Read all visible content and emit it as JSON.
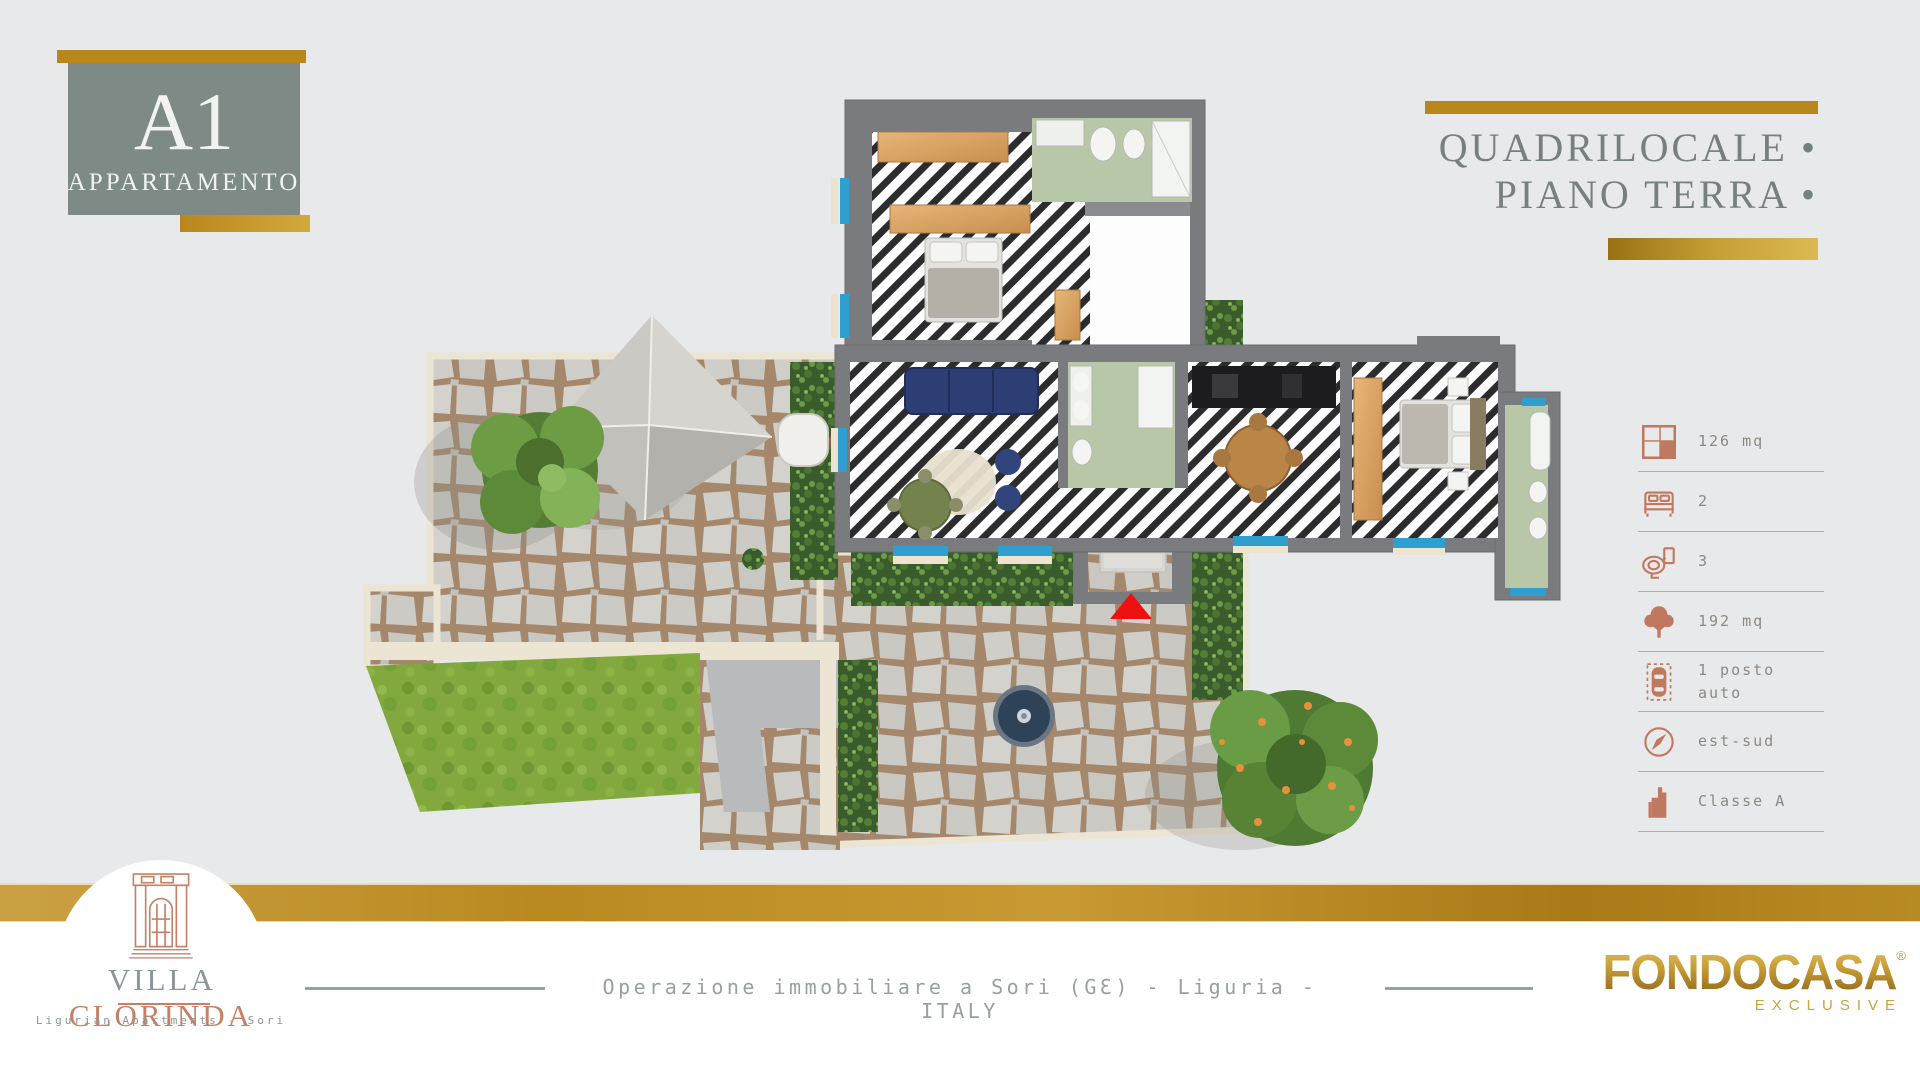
{
  "badge": {
    "code": "A1",
    "label": "APPARTAMENTO"
  },
  "title": {
    "line1": "QUADRILOCALE •",
    "line2": "PIANO TERRA •"
  },
  "specs": {
    "items": [
      {
        "icon": "area-icon",
        "label": "126 mq"
      },
      {
        "icon": "bed-icon",
        "label": "2"
      },
      {
        "icon": "toilet-icon",
        "label": "3"
      },
      {
        "icon": "garden-icon",
        "label": "192 mq"
      },
      {
        "icon": "parking-icon",
        "label": "1 posto auto"
      },
      {
        "icon": "compass-icon",
        "label": "est-sud"
      },
      {
        "icon": "energy-class-icon",
        "label": "Classe A"
      }
    ]
  },
  "plan": {
    "entrance_marker_icon": "red-triangle-icon"
  },
  "footer": {
    "brand_left": {
      "name_primary": "VILLA",
      "name_secondary": "CLORINDA",
      "tagline": "Ligurian Apartments - Sori"
    },
    "center_text": "Operazione immobiliare a Sori (GƐ) - Liguria - ITALY",
    "brand_right": {
      "name": "FONDOCASA",
      "registered_mark": "®",
      "sub": "EXCLUSIVE"
    }
  },
  "colors": {
    "gold": "#b8871c",
    "goldLight": "#d9b84e",
    "badgeBg": "#7e8a85",
    "titleGray": "#76817e",
    "terracotta": "#bf7960",
    "divider": "#d8a18c",
    "specText": "#8d8883",
    "footerText": "#98a0a0",
    "pageBg": "#e8e9ea",
    "villaGray": "#8b969a",
    "villaTerra": "#c38165",
    "fondGold": "#b08c2e"
  }
}
